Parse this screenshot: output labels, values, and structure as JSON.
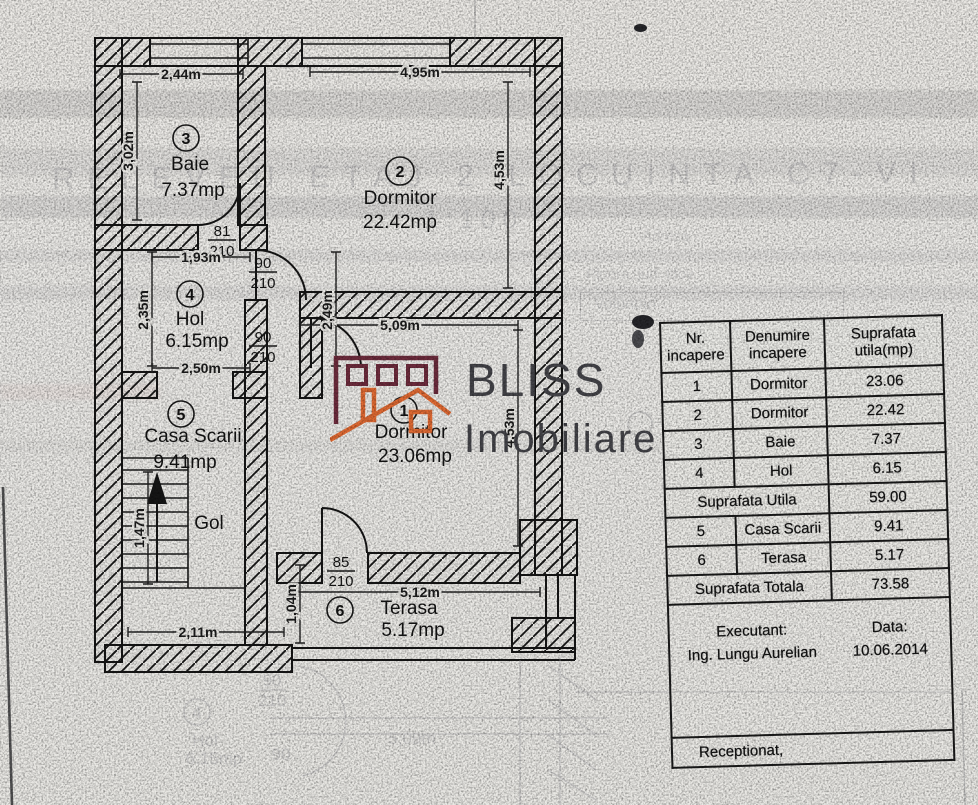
{
  "scan": {
    "ghost_title": "RELEVEU ETAJ 2 LOCUINTA C7-VILA 7",
    "ghost_scale": "1:100",
    "ghost_addr1": "Adresa",
    "ghost_addr2": "Pipera, jud. Ilfov",
    "ghost_addr3": "Voluntari",
    "ghost_room_num": "4",
    "ghost_room_name": "Hol",
    "ghost_room_area": "6.15mp",
    "ghost_door_w": "90",
    "ghost_door_h": "210",
    "ghost_door_w2": "90",
    "ghost_dim": "5,09m"
  },
  "plan": {
    "rooms": {
      "baie": {
        "num": "3",
        "name": "Baie",
        "area": "7.37mp"
      },
      "dormitor2": {
        "num": "2",
        "name": "Dormitor",
        "area": "22.42mp"
      },
      "hol": {
        "num": "4",
        "name": "Hol",
        "area": "6.15mp"
      },
      "casa_scarii": {
        "num": "5",
        "name": "Casa Scarii",
        "area": "9.41mp"
      },
      "dormitor1": {
        "num": "1",
        "name": "Dormitor",
        "area": "23.06mp"
      },
      "terasa": {
        "num": "6",
        "name": "Terasa",
        "area": "5.17mp"
      },
      "gol": {
        "name": "Gol"
      }
    },
    "dims": {
      "baie_top": "2,44m",
      "baie_left": "3,02m",
      "dorm2_top": "4,95m",
      "dorm2_right": "4,53m",
      "hol_top": "1,93m",
      "hol_left": "2,35m",
      "hol_mid": "2,49m",
      "hol_bottom": "2,50m",
      "dorm1_top": "5,09m",
      "dorm1_right": "4,53m",
      "scara_mid": "1,47m",
      "scara_bottom": "2,11m",
      "terasa_left": "1,04m",
      "terasa_top": "5,12m"
    },
    "doors": {
      "baie": {
        "w": "81",
        "h": "210"
      },
      "hol_top": {
        "w": "90",
        "h": "210"
      },
      "hol_bottom": {
        "w": "90",
        "h": "210"
      },
      "terasa": {
        "w": "85",
        "h": "210"
      }
    }
  },
  "logo": {
    "name": "BLISS",
    "tagline": "Imobiliare",
    "maroon": "#6e2c3d",
    "orange": "#e06a33",
    "gray": "#45454a"
  },
  "table": {
    "headers": {
      "col1": "Nr.\nincapere",
      "col2": "Denumire\nincapere",
      "col3": "Suprafata\nutila(mp)"
    },
    "rows": [
      {
        "nr": "1",
        "name": "Dormitor",
        "area": "23.06"
      },
      {
        "nr": "2",
        "name": "Dormitor",
        "area": "22.42"
      },
      {
        "nr": "3",
        "name": "Baie",
        "area": "7.37"
      },
      {
        "nr": "4",
        "name": "Hol",
        "area": "6.15"
      }
    ],
    "subtotal": {
      "label": "Suprafata Utila",
      "value": "59.00"
    },
    "rows2": [
      {
        "nr": "5",
        "name": "Casa Scarii",
        "area": "9.41"
      },
      {
        "nr": "6",
        "name": "Terasa",
        "area": "5.17"
      }
    ],
    "total": {
      "label": "Suprafata Totala",
      "value": "73.58"
    },
    "executant_label": "Executant:",
    "executant_name": "Ing. Lungu Aurelian",
    "date_label": "Data:",
    "date_value": "10.06.2014",
    "receptionat": "Receptionat,"
  }
}
